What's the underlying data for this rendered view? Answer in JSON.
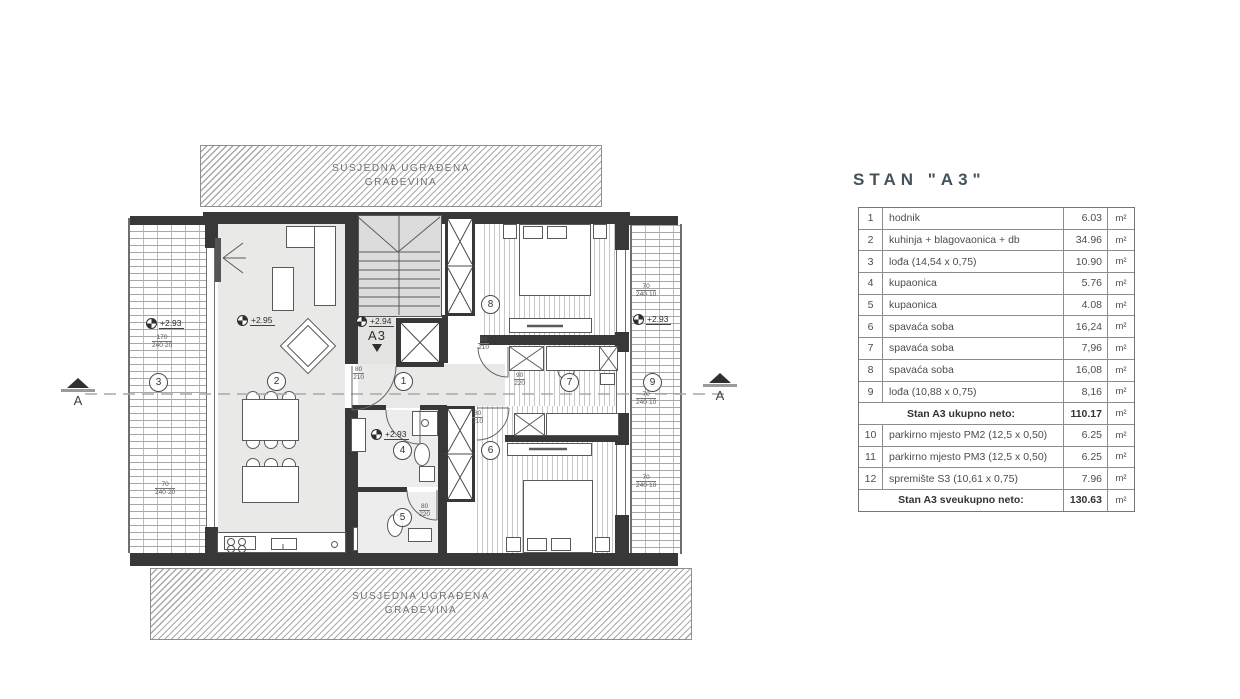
{
  "title": "STAN \"A3\"",
  "neighbor_top": {
    "line1": "SUSJEDNA UGRAĐENA",
    "line2": "GRAĐEVINA"
  },
  "neighbor_bottom": {
    "line1": "SUSJEDNA UGRAĐENA",
    "line2": "GRAĐEVINA"
  },
  "section": {
    "label": "A"
  },
  "entry": {
    "label": "A3",
    "level": "+2.94"
  },
  "plan": {
    "room_labels": [
      {
        "no": "1",
        "x": 394,
        "y": 372
      },
      {
        "no": "2",
        "x": 267,
        "y": 372
      },
      {
        "no": "3",
        "x": 149,
        "y": 373
      },
      {
        "no": "4",
        "x": 393,
        "y": 441
      },
      {
        "no": "5",
        "x": 393,
        "y": 508
      },
      {
        "no": "6",
        "x": 481,
        "y": 441
      },
      {
        "no": "7",
        "x": 560,
        "y": 373
      },
      {
        "no": "8",
        "x": 481,
        "y": 295
      },
      {
        "no": "9",
        "x": 643,
        "y": 373
      }
    ],
    "levels": [
      {
        "text": "+2.93",
        "x": 146,
        "y": 318
      },
      {
        "text": "+2.95",
        "x": 237,
        "y": 315
      },
      {
        "text": "+2.93",
        "x": 371,
        "y": 429
      },
      {
        "text": "+2.93",
        "x": 633,
        "y": 314
      }
    ],
    "window_dims": [
      {
        "w": "170",
        "h": "240·20",
        "x": 152,
        "y": 334
      },
      {
        "w": "70",
        "h": "240·20",
        "x": 155,
        "y": 481
      },
      {
        "w": "70",
        "h": "240·10",
        "x": 636,
        "y": 283
      },
      {
        "w": "70",
        "h": "240·10",
        "x": 636,
        "y": 391
      },
      {
        "w": "70",
        "h": "240·10",
        "x": 636,
        "y": 474
      }
    ],
    "door_dims": [
      {
        "w": "80",
        "h": "210",
        "x": 353,
        "y": 366
      },
      {
        "w": "80",
        "h": "210",
        "x": 478,
        "y": 336
      },
      {
        "w": "90",
        "h": "220",
        "x": 514,
        "y": 372
      },
      {
        "w": "80",
        "h": "220",
        "x": 419,
        "y": 503
      },
      {
        "w": "80",
        "h": "210",
        "x": 472,
        "y": 410
      }
    ]
  },
  "table": {
    "rows": [
      {
        "no": "1",
        "name": "hodnik",
        "value": "6.03",
        "unit": "m²"
      },
      {
        "no": "2",
        "name": "kuhinja + blagovaonica + db",
        "value": "34.96",
        "unit": "m²"
      },
      {
        "no": "3",
        "name": "lođa (14,54 x 0,75)",
        "value": "10.90",
        "unit": "m²"
      },
      {
        "no": "4",
        "name": "kupaonica",
        "value": "5.76",
        "unit": "m²"
      },
      {
        "no": "5",
        "name": "kupaonica",
        "value": "4.08",
        "unit": "m²"
      },
      {
        "no": "6",
        "name": "spavaća soba",
        "value": "16,24",
        "unit": "m²"
      },
      {
        "no": "7",
        "name": "spavaća soba",
        "value": "7,96",
        "unit": "m²"
      },
      {
        "no": "8",
        "name": "spavaća soba",
        "value": "16,08",
        "unit": "m²"
      },
      {
        "no": "9",
        "name": "lođa (10,88 x 0,75)",
        "value": "8,16",
        "unit": "m²"
      },
      {
        "no": "",
        "name": "Stan A3 ukupno neto:",
        "value": "110.17",
        "unit": "m²",
        "total": true
      },
      {
        "no": "10",
        "name": "parkirno mjesto PM2 (12,5 x 0,50)",
        "value": "6.25",
        "unit": "m²"
      },
      {
        "no": "11",
        "name": "parkirno mjesto PM3 (12,5 x 0,50)",
        "value": "6.25",
        "unit": "m²"
      },
      {
        "no": "12",
        "name": "spremište S3 (10,61 x 0,75)",
        "value": "7.96",
        "unit": "m²"
      },
      {
        "no": "",
        "name": "Stan A3 sveukupno neto:",
        "value": "130.63",
        "unit": "m²",
        "total": true
      }
    ]
  }
}
